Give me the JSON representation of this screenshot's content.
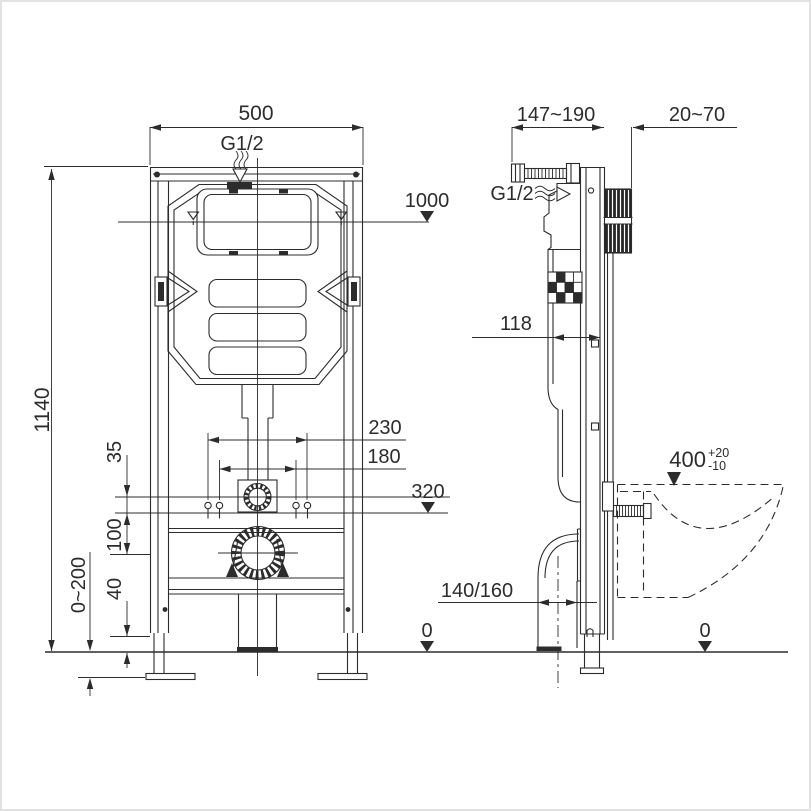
{
  "front": {
    "width": "500",
    "inlet": "G1/2",
    "level": "1000",
    "height": "1140",
    "spacing_outer": "230",
    "spacing_inner": "180",
    "outlet_height": "320",
    "dim35": "35",
    "dim100": "100",
    "dim40": "40",
    "foot_range": "0~200"
  },
  "side": {
    "depth_range": "147~190",
    "wall_range": "20~70",
    "inlet": "G1/2",
    "cistern_depth": "118",
    "bowl_height": "400",
    "bowl_tol_up": "+20",
    "bowl_tol_down": "-10",
    "drain_pipe": "140/160"
  },
  "ground": {
    "zero_left": "0",
    "zero_right": "0"
  },
  "colors": {
    "line": "#2c2c2c",
    "background": "#ffffff",
    "border": "#e2e2e2"
  }
}
